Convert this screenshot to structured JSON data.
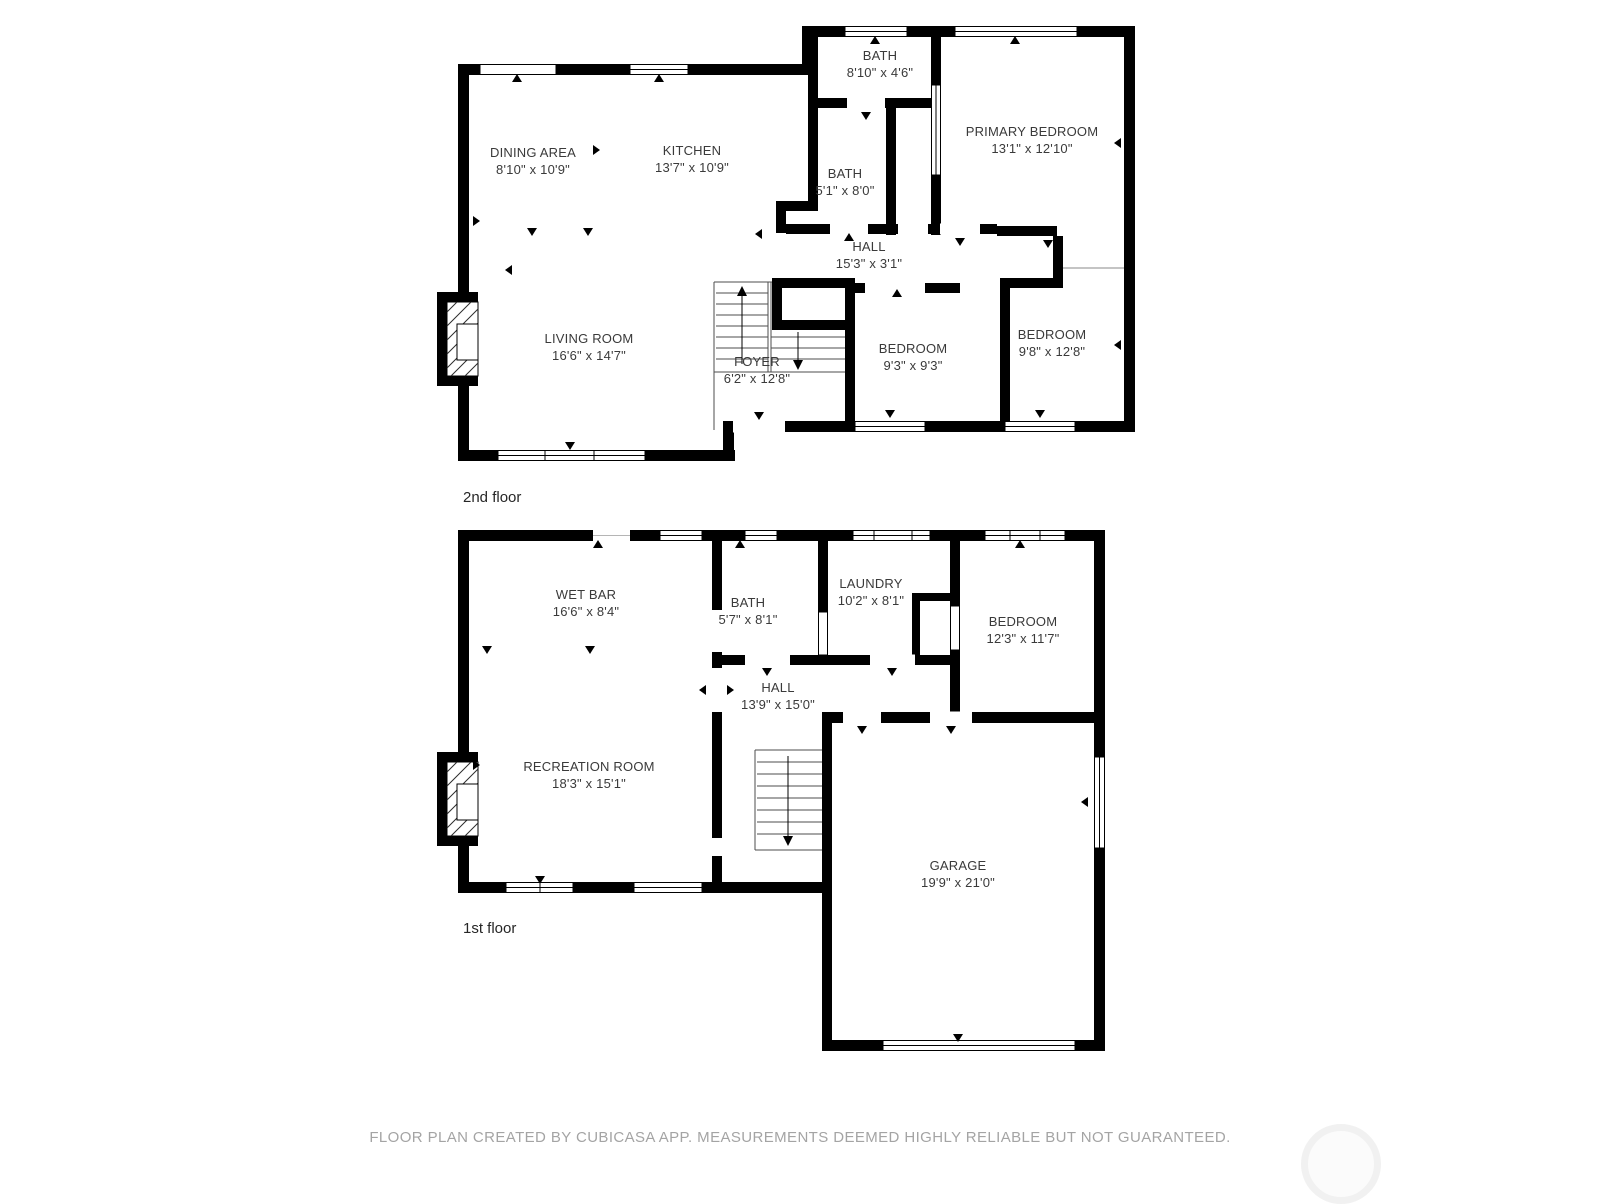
{
  "floors": [
    {
      "label": "2nd floor",
      "rooms": [
        {
          "name": "DINING AREA",
          "dims": "8'10\" x 10'9\""
        },
        {
          "name": "KITCHEN",
          "dims": "13'7\" x 10'9\""
        },
        {
          "name": "BATH",
          "dims": "8'10\" x 4'6\""
        },
        {
          "name": "BATH",
          "dims": "5'1\" x 8'0\""
        },
        {
          "name": "PRIMARY BEDROOM",
          "dims": "13'1\" x 12'10\""
        },
        {
          "name": "HALL",
          "dims": "15'3\" x 3'1\""
        },
        {
          "name": "LIVING ROOM",
          "dims": "16'6\" x 14'7\""
        },
        {
          "name": "FOYER",
          "dims": "6'2\" x 12'8\""
        },
        {
          "name": "BEDROOM",
          "dims": "9'3\" x 9'3\""
        },
        {
          "name": "BEDROOM",
          "dims": "9'8\" x 12'8\""
        }
      ]
    },
    {
      "label": "1st floor",
      "rooms": [
        {
          "name": "WET BAR",
          "dims": "16'6\" x 8'4\""
        },
        {
          "name": "BATH",
          "dims": "5'7\" x 8'1\""
        },
        {
          "name": "LAUNDRY",
          "dims": "10'2\" x 8'1\""
        },
        {
          "name": "BEDROOM",
          "dims": "12'3\" x 11'7\""
        },
        {
          "name": "HALL",
          "dims": "13'9\" x 15'0\""
        },
        {
          "name": "RECREATION ROOM",
          "dims": "18'3\" x 15'1\""
        },
        {
          "name": "GARAGE",
          "dims": "19'9\" x 21'0\""
        }
      ]
    }
  ],
  "footer": {
    "disclaimer": "FLOOR PLAN CREATED BY CUBICASA APP. MEASUREMENTS DEEMED HIGHLY RELIABLE BUT NOT GUARANTEED."
  },
  "colors": {
    "wall": "#000000",
    "label_text": "#3a3a3a",
    "footer_text": "#a4a4a4",
    "watermark": "#f1f1f1"
  }
}
